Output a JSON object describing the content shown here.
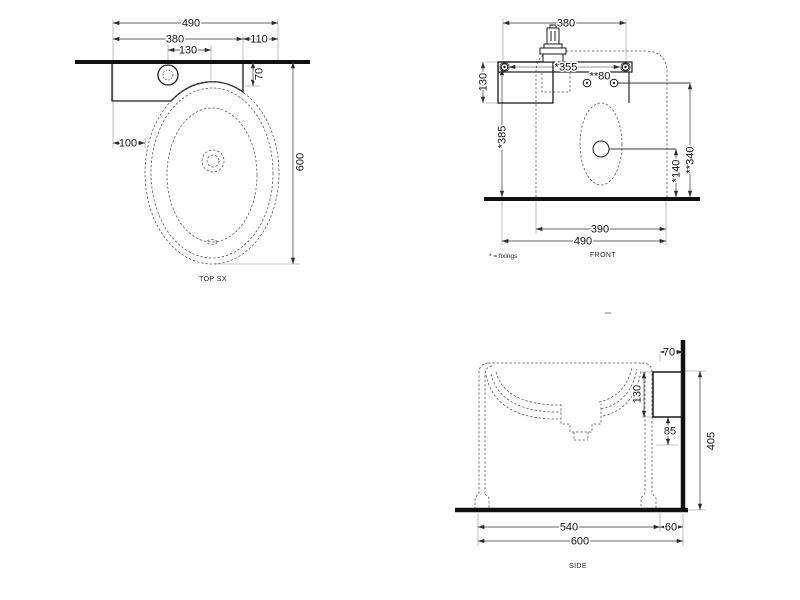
{
  "views": {
    "top": {
      "label": "TOP SX",
      "dims": {
        "overall_width": "490",
        "shelf_width": "380",
        "right_offset": "110",
        "tap_offset": "130",
        "left_offset": "100",
        "shelf_depth": "70",
        "overall_depth": "600"
      }
    },
    "front": {
      "label": "FRONT",
      "fixings_note": "* = fixings",
      "dims": {
        "fixing_centres_width": "380",
        "bracket_width": "*355",
        "tap_fixing_spacing": "**80",
        "shelf_height": "130",
        "fixing_height": "*385",
        "drain_height": "*140",
        "tap_fixing_height": "**340",
        "basin_width": "390",
        "overall_width": "490"
      }
    },
    "side": {
      "label": "SIDE",
      "dims": {
        "rim_to_wall": "70",
        "bracket_height": "130",
        "bracket_clearance": "85",
        "bracket_top_height": "405",
        "basin_depth": "540",
        "wall_offset": "60",
        "overall_depth": "600"
      }
    }
  }
}
